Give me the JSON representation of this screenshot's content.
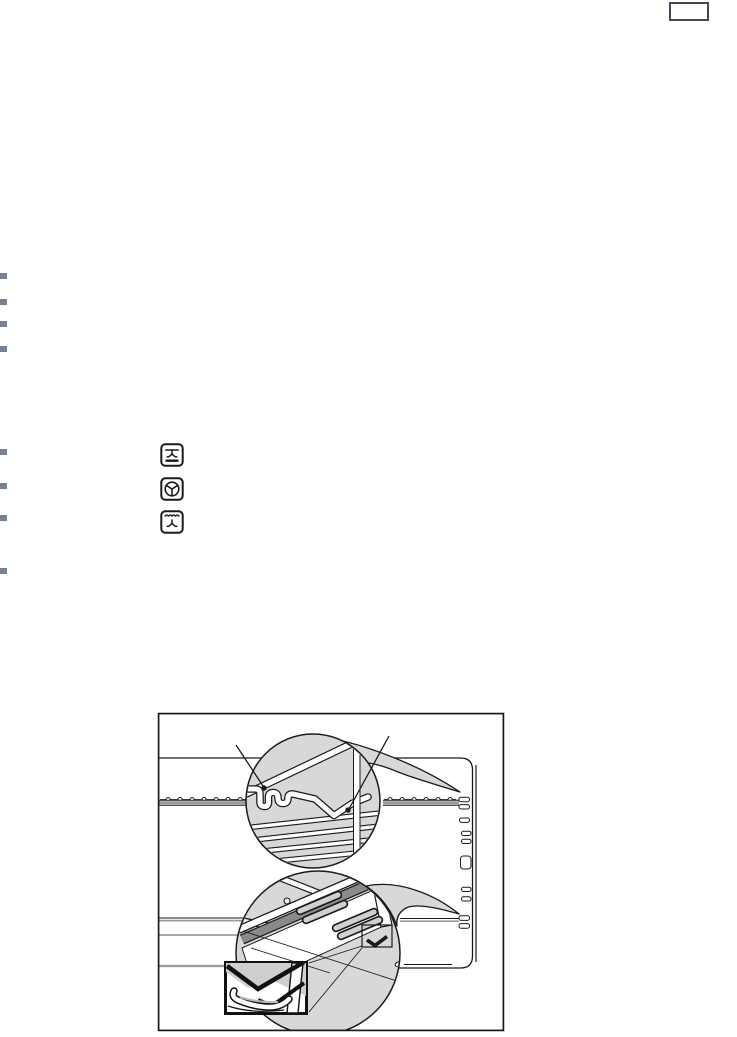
{
  "page": {
    "width": 737,
    "height": 1035,
    "background": "#ffffff"
  },
  "header": {
    "page_number_box": ""
  },
  "colors": {
    "bullet": "#76828d",
    "page_box_border": "#3f4a56",
    "line": "#1a1a1a",
    "callout_fill": "#d8d8d8",
    "rail_dark": "#8a8a8a",
    "gray_line": "#9b9b9b",
    "inset_gray": "#cfcfcf",
    "slot_gray": "#d0d0d0"
  },
  "bullet_groups": {
    "group1": {
      "count": 4
    },
    "group2": {
      "count": 4
    }
  },
  "oven_function_icons": [
    {
      "name": "fan-with-top-and-bottom-heat-icon"
    },
    {
      "name": "hot-air-fan-icon"
    },
    {
      "name": "grill-with-fan-icon"
    }
  ],
  "figure": {
    "name": "oven-shelf-runner-illustration",
    "callout_circles": 2,
    "detail_insets": 1,
    "leader_dots": 2
  }
}
